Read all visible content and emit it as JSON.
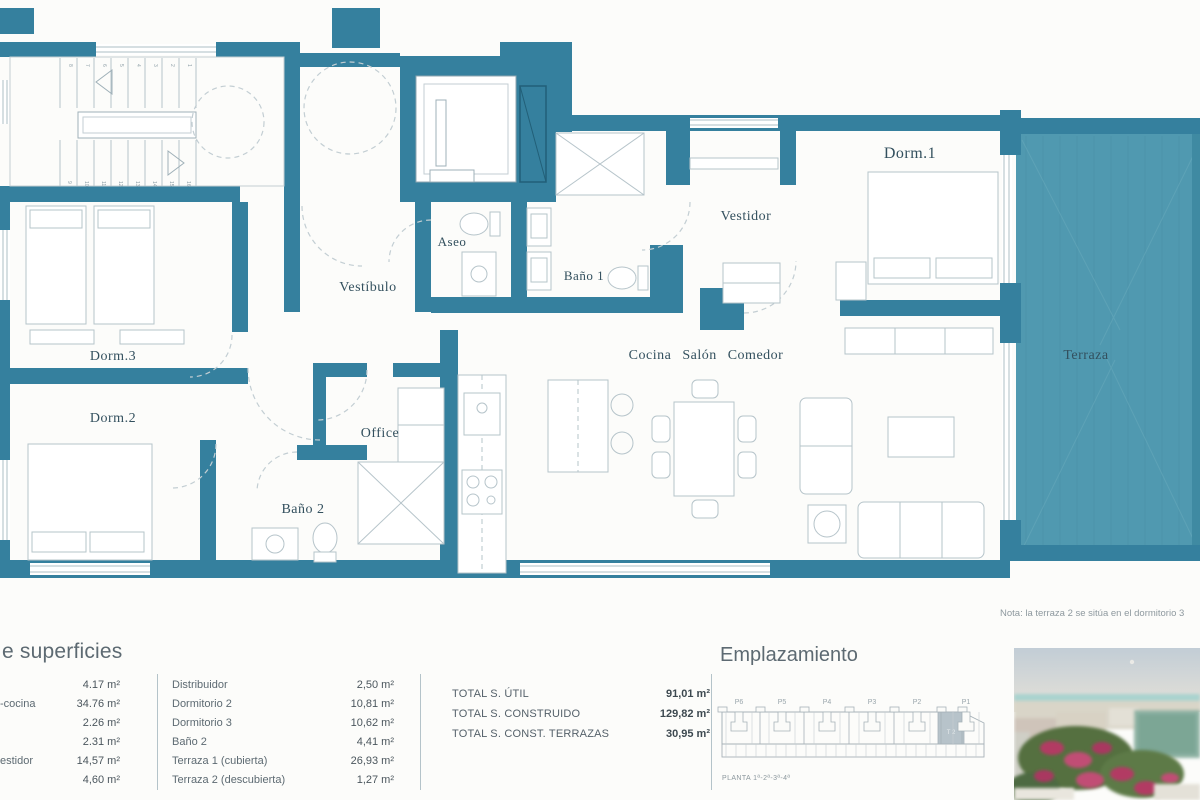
{
  "colors": {
    "wall": "#35809e",
    "terrace_fill": "#5099b0",
    "terrace_stripe": "#478fa6",
    "furniture_stroke": "#b6c4ca",
    "label_ink": "#33505e",
    "table_ink": "#5d6a72",
    "highlight_unit": "#b7c3ca"
  },
  "plan": {
    "note": "Nota: la terraza 2 se sitúa en el dormitorio 3",
    "rooms": {
      "dorm1": "Dorm.1",
      "vestidor": "Vestidor",
      "aseo": "Aseo",
      "bano1": "Baño 1",
      "vestibulo": "Vestíbulo",
      "salon": "Cocina Salón Comedor",
      "dorm3": "Dorm.3",
      "dorm2": "Dorm.2",
      "office": "Office",
      "bano2": "Baño 2",
      "terraza": "Terraza"
    },
    "stair_numbers": [
      "1",
      "2",
      "3",
      "4",
      "5",
      "6",
      "7",
      "8",
      "9",
      "10",
      "11",
      "12",
      "13",
      "14",
      "15",
      "16"
    ]
  },
  "surfaces": {
    "title_fragment": "e superficies",
    "col1": [
      {
        "label": "",
        "value": "4.17 m²"
      },
      {
        "label": "-cocina",
        "value": "34.76 m²"
      },
      {
        "label": "",
        "value": "2.26 m²"
      },
      {
        "label": "",
        "value": "2.31 m²"
      },
      {
        "label": "estidor",
        "value": "14,57 m²"
      },
      {
        "label": "",
        "value": "4,60 m²"
      }
    ],
    "col2": [
      {
        "label": "Distribuidor",
        "value": "2,50 m²"
      },
      {
        "label": "Dormitorio 2",
        "value": "10,81 m²"
      },
      {
        "label": "Dormitorio 3",
        "value": "10,62 m²"
      },
      {
        "label": "Baño 2",
        "value": "4,41 m²"
      },
      {
        "label": "Terraza 1 (cubierta)",
        "value": "26,93 m²"
      },
      {
        "label": "Terraza 2 (descubierta)",
        "value": "1,27 m²"
      }
    ],
    "totals": [
      {
        "label": "TOTAL S. ÚTIL",
        "value": "91,01 m²"
      },
      {
        "label": "TOTAL S. CONSTRUIDO",
        "value": "129,82 m²"
      },
      {
        "label": "TOTAL S. CONST. TERRAZAS",
        "value": "30,95 m²"
      }
    ]
  },
  "emplazamiento": {
    "title": "Emplazamiento",
    "portals": [
      "P6",
      "P5",
      "P4",
      "P3",
      "P2",
      "P1"
    ],
    "highlight_label": "T 2",
    "caption": "PLANTA 1ª-2ª-3ª-4ª"
  }
}
